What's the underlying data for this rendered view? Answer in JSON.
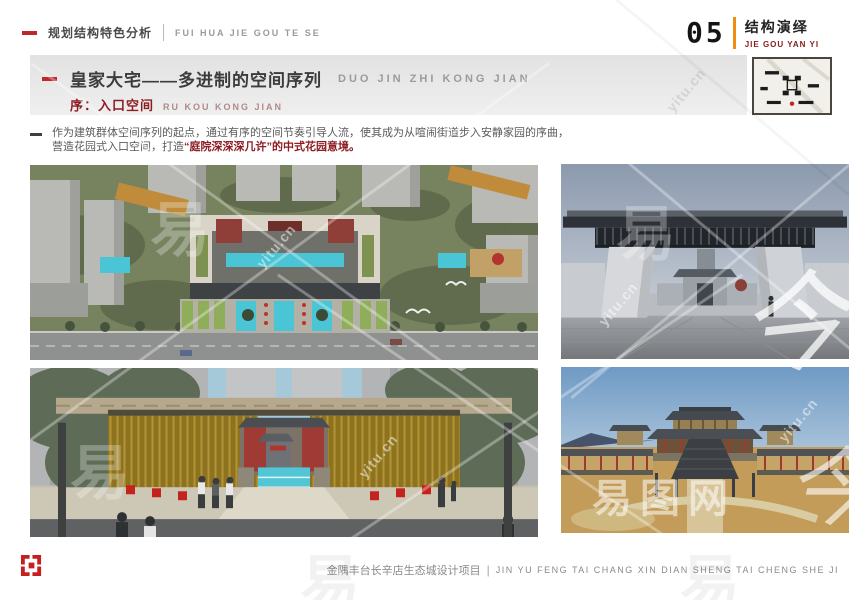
{
  "header": {
    "left": {
      "title": "规划结构特色分析",
      "pinyin": "FUI HUA JIE GOU TE SE"
    },
    "right": {
      "number": "05",
      "title": "结构演绎",
      "pinyin": "JIE GOU YAN YI"
    }
  },
  "title_block": {
    "title": "皇家大宅——多进制的空间序列",
    "title_pinyin": "DUO JIN ZHI KONG JIAN",
    "subtitle_label": "序",
    "subtitle_separator": "：",
    "subtitle": "入口空间",
    "subtitle_pinyin": "RU KOU KONG JIAN"
  },
  "paragraph": {
    "line1": "作为建筑群体空间序列的起点，通过有序的空间节奏引导人流，使其成为从喧闹街道步入安静家园的序曲，",
    "line2_normal": "营造花园式入口空间，打造",
    "line2_highlight": "“庭院深深深几许”的中式花园意境。"
  },
  "footer": {
    "project": "金隅丰台长辛店生态城设计项目",
    "divider": "|",
    "pinyin": "JIN YU FENG TAI CHANG XIN DIAN SHENG TAI CHENG SHE JI"
  },
  "watermarks": {
    "char": "易",
    "url": "yitu.cn",
    "sitename": "易图网",
    "calligraphy": "今"
  },
  "colors": {
    "accent_red": "#c0272d",
    "dark_red": "#8e1d22",
    "accent_orange": "#ef8d13",
    "band_gray": "#e9e9e9",
    "text_dark": "#3c3c3c",
    "text_gray": "#8a8a8a",
    "pool_cyan": "#49c5d5"
  }
}
